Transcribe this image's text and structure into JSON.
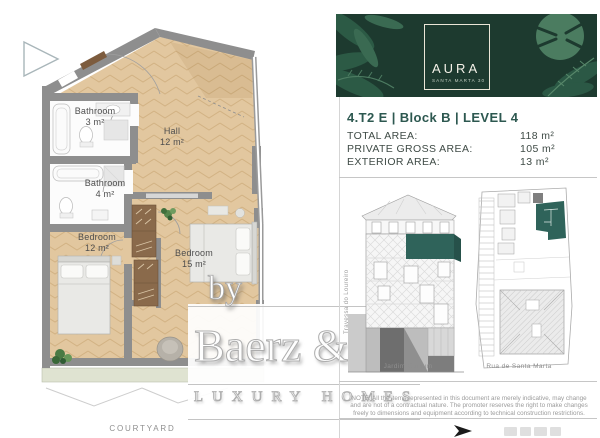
{
  "floor_plan": {
    "rooms": [
      {
        "name": "Bathroom",
        "area": "3 m²"
      },
      {
        "name": "Hall",
        "area": "12 m²"
      },
      {
        "name": "Bathroom",
        "area": "4 m²"
      },
      {
        "name": "Bedroom",
        "area": "12 m²"
      },
      {
        "name": "Bedroom",
        "area": "15 m²"
      }
    ],
    "courtyard_label": "COURTYARD"
  },
  "watermark": {
    "prefix": "by",
    "brand": "Baerz & Co",
    "tagline": "LUXURY HOMES"
  },
  "info_panel": {
    "brand": {
      "logo_text": "AURA",
      "logo_subtitle": "SANTA MARTA 30"
    },
    "unit_title": "4.T2 E | Block B | LEVEL 4",
    "areas": [
      {
        "label": "TOTAL AREA:",
        "value": "118 m²"
      },
      {
        "label": "PRIVATE GROSS AREA:",
        "value": "105 m²"
      },
      {
        "label": "EXTERIOR AREA:",
        "value": "13 m²"
      }
    ],
    "diagrams": {
      "street_label_vertical": "Travessa do Loureiro",
      "elevation_caption": "Jardim Comum",
      "site_plan_caption": "Rua de Santa Marta"
    },
    "disclaimer": "NOTE: All the items represented in this document are merely indicative, may change and are not of a contractual nature. The promoter reserves the right to make changes freely to dimensions and equipment according to technical construction restrictions."
  },
  "colors": {
    "banner_green": "#1d3a2f",
    "highlight_teal": "#2f635a",
    "floor_tan": "#e2c79f",
    "exterior_green": "#dfe3d1"
  }
}
